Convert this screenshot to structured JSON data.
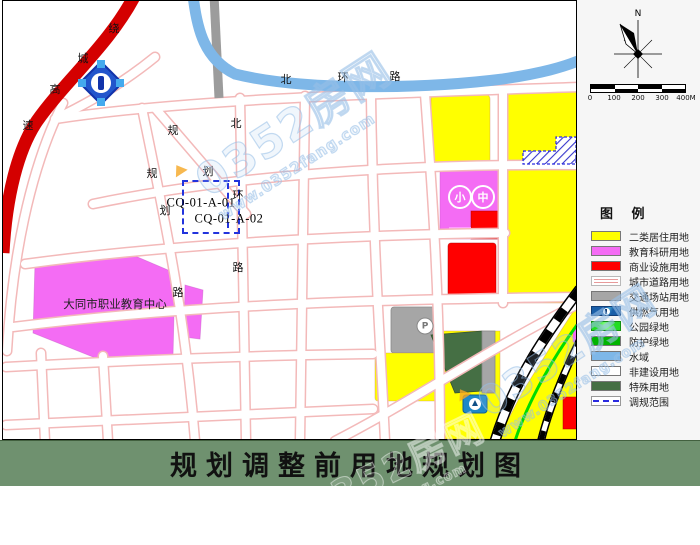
{
  "title_bar": {
    "text": "规划调整前用地规划图"
  },
  "compass": {
    "north_label": "N"
  },
  "scalebar": {
    "labels": [
      "0",
      "100",
      "200",
      "300",
      "400M"
    ]
  },
  "legend": {
    "title": "图 例",
    "items": [
      {
        "label": "二类居住用地",
        "swatch": "solid",
        "color": "#FFFF00"
      },
      {
        "label": "教育科研用地",
        "swatch": "solid",
        "color": "#F46CF4"
      },
      {
        "label": "商业设施用地",
        "swatch": "solid",
        "color": "#FF0000"
      },
      {
        "label": "城市道路用地",
        "swatch": "road",
        "color": "#FFFFFF"
      },
      {
        "label": "交通场站用地",
        "swatch": "solid",
        "color": "#A6A6A6"
      },
      {
        "label": "供燃气用地",
        "swatch": "gas",
        "color": "#1A5FA8"
      },
      {
        "label": "公园绿地",
        "swatch": "park",
        "color": "#22DD22"
      },
      {
        "label": "防护绿地",
        "swatch": "solid",
        "color": "#00B400"
      },
      {
        "label": "水域",
        "swatch": "solid",
        "color": "#7EB7E8"
      },
      {
        "label": "非建设用地",
        "swatch": "solid",
        "color": "#FFFFFF"
      },
      {
        "label": "特殊用地",
        "swatch": "solid",
        "color": "#456F44"
      },
      {
        "label": "调规范围",
        "swatch": "dashed",
        "color": "#2A2AE0"
      }
    ]
  },
  "map": {
    "site_label": "大同市职业教育中心",
    "parcel_codes": [
      {
        "text": "CQ-01-A-01",
        "x": 198,
        "y": 202
      },
      {
        "text": "CQ-01-A-02",
        "x": 226,
        "y": 218
      }
    ],
    "road_labels": [
      {
        "t": "绕",
        "x": 111,
        "y": 27
      },
      {
        "t": "城",
        "x": 80,
        "y": 57
      },
      {
        "t": "高",
        "x": 52,
        "y": 88
      },
      {
        "t": "速",
        "x": 25,
        "y": 124
      },
      {
        "t": "北",
        "x": 283,
        "y": 78
      },
      {
        "t": "环",
        "x": 340,
        "y": 76
      },
      {
        "t": "路",
        "x": 392,
        "y": 75
      },
      {
        "t": "规",
        "x": 170,
        "y": 129
      },
      {
        "t": "划",
        "x": 205,
        "y": 170
      },
      {
        "t": "规",
        "x": 149,
        "y": 172
      },
      {
        "t": "划",
        "x": 162,
        "y": 209
      },
      {
        "t": "路",
        "x": 175,
        "y": 291
      },
      {
        "t": "北",
        "x": 233,
        "y": 122
      },
      {
        "t": "环",
        "x": 235,
        "y": 194
      },
      {
        "t": "路",
        "x": 235,
        "y": 266
      }
    ],
    "markers": [
      {
        "t": "小",
        "x": 457,
        "y": 196,
        "style": "school"
      },
      {
        "t": "中",
        "x": 480,
        "y": 196,
        "style": "school"
      },
      {
        "t": "P",
        "x": 422,
        "y": 325,
        "style": "parking"
      }
    ]
  },
  "watermark": {
    "brand": "0352房网",
    "url": "www.0352fang.com"
  },
  "palette": {
    "residential": "#FFFF00",
    "education": "#F46CF4",
    "edu_light": "#FF9EFF",
    "commercial": "#FF0000",
    "transport": "#A6A6A6",
    "special": "#456F44",
    "park_green": "#22DD22",
    "protect_green": "#00B400",
    "water": "#7EB7E8",
    "gas_blue": "#1A5FA8",
    "adjust_blue": "#2A2AE0",
    "expressway_red": "#D40000",
    "road_edge": "#F3B9B9",
    "title_bar_green": "#6F916F"
  }
}
